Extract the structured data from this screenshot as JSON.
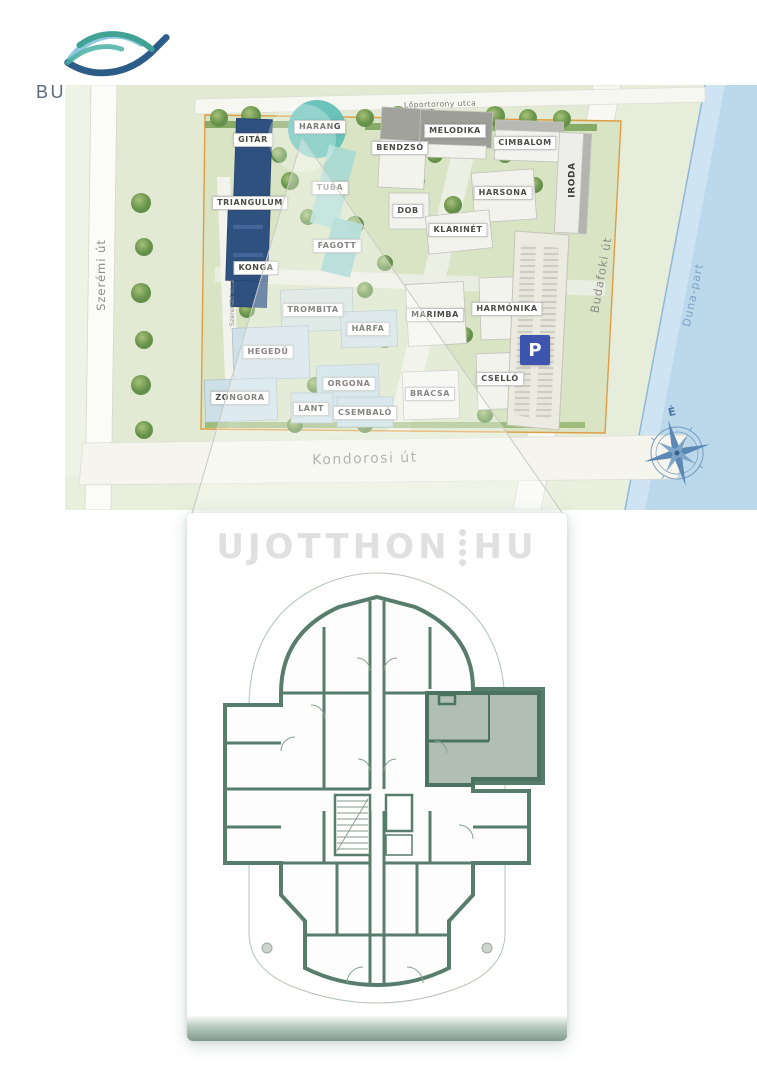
{
  "logo": {
    "brand": "BUDAI WALZER",
    "byline_by": "by",
    "byline_name": "SISKIN"
  },
  "site_plan": {
    "streets": {
      "top": "Lőportorony utca",
      "left": "Szerémi út",
      "inner_left": "Szerenád utca",
      "right": "Budafoki út",
      "bottom": "Kondorosi út",
      "river": "Duna-part"
    },
    "compass_north": "É",
    "parking_badge": "P",
    "buildings": [
      {
        "label": "GITÁR"
      },
      {
        "label": "HARANG"
      },
      {
        "label": "BENDZSÓ"
      },
      {
        "label": "MELODIKA"
      },
      {
        "label": "CIMBALOM"
      },
      {
        "label": "IRODA"
      },
      {
        "label": "TRIANGULUM"
      },
      {
        "label": "TUBA"
      },
      {
        "label": "DOB"
      },
      {
        "label": "HARSONA"
      },
      {
        "label": "KLARINÉT"
      },
      {
        "label": "FAGOTT"
      },
      {
        "label": "KONGA"
      },
      {
        "label": "TROMBITA"
      },
      {
        "label": "MARIMBA"
      },
      {
        "label": "HARMÓNIKA"
      },
      {
        "label": "HÁRFA"
      },
      {
        "label": "HEGEDŰ"
      },
      {
        "label": "CSELLÓ"
      },
      {
        "label": "ZONGORA"
      },
      {
        "label": "ORGONA"
      },
      {
        "label": "LANT"
      },
      {
        "label": "CSEMBALÓ"
      },
      {
        "label": "BRÁCSA"
      }
    ]
  },
  "floor_plan": {
    "watermark_left": "UJOTTHON",
    "watermark_right": "HU"
  },
  "colors": {
    "brand_teal": "#3fa294",
    "brand_navy": "#2c5d88",
    "brand_lightblue": "#8fc8de",
    "brand_text": "#5a6a7a",
    "blue_building": "#2f517f",
    "teal_building": "#63c0b8",
    "plan_wall": "#587d6c",
    "highlight_unit": "#b0bfb2",
    "parking_blue": "#3d55ae",
    "river": "#bcd9ec",
    "site_boundary": "#e09c43",
    "watermark": "#e0e0e0"
  }
}
